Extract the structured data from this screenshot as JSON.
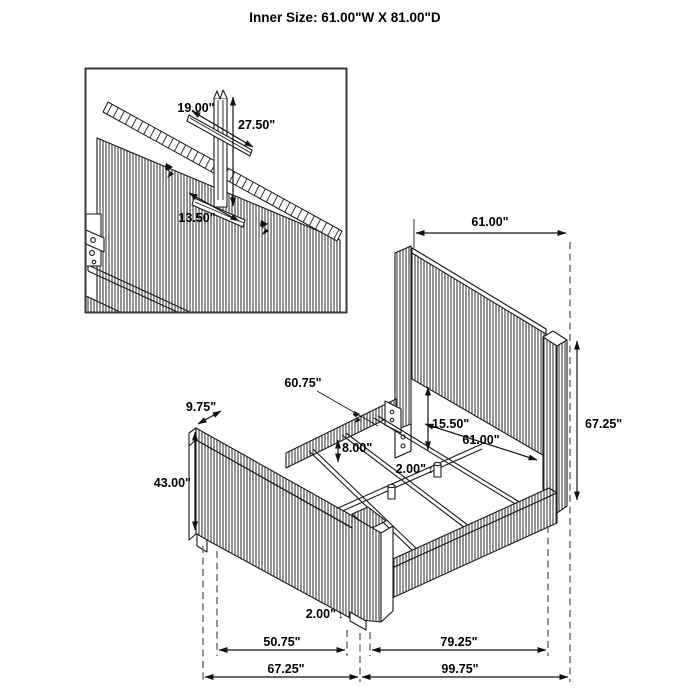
{
  "title": "Inner Size: 61.00\"W X 81.00\"D",
  "symbols": {
    "updown_arrow": "↕"
  },
  "colors": {
    "line": "#1a1a1a",
    "dim_line": "#111111",
    "dashed_extension": "#666666",
    "text": "#000000",
    "background": "#ffffff"
  },
  "inset_detail": {
    "dim_bracket_width": "19.00\"",
    "dim_strut_height": "27.50\"",
    "dim_cleat_width": "13.50\""
  },
  "main_view": {
    "dim_headboard_width": "61.00\"",
    "dim_headboard_height": "67.25\"",
    "dim_side_rail_length": "60.75\"",
    "dim_footboard_top_depth": "9.75\"",
    "dim_rail_top_height": "8.00\"",
    "dim_panel_clearance": "15.50\"",
    "dim_inner_width": "61.00\"",
    "dim_center_leg_height": "2.00\"",
    "dim_footboard_height": "43.00\"",
    "dim_foot_leg_height": "2.00\"",
    "dim_footboard_inner_span": "50.75\"",
    "dim_rail_span": "79.25\"",
    "dim_footboard_outer_span": "67.25\"",
    "dim_overall_depth": "99.75\""
  }
}
